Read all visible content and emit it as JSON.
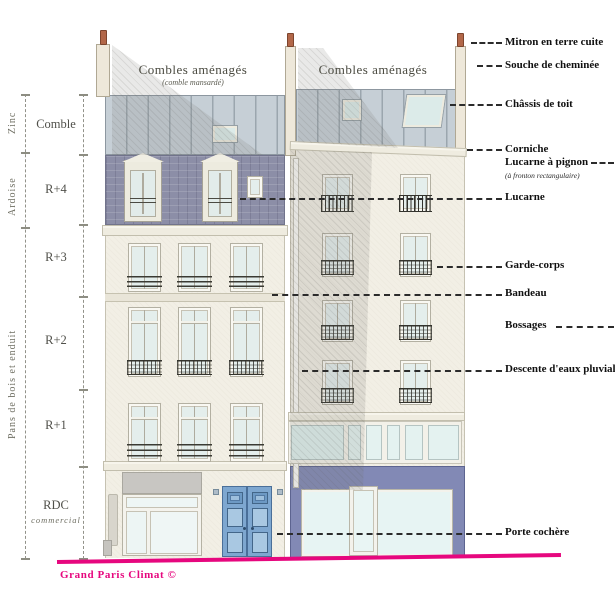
{
  "left_scale": {
    "materials": [
      "Zinc",
      "Ardoise",
      "Pans de bois   et enduit"
    ],
    "floors": [
      "Comble",
      "R+4",
      "R+3",
      "R+2",
      "R+1",
      "RDC"
    ],
    "rdc_sublabel": "commercial"
  },
  "roof": {
    "left_title": "Combles aménagés",
    "left_subtitle": "(comble mansardé)",
    "right_title": "Combles aménagés"
  },
  "annotations": [
    {
      "label": "Mitron en terre cuite"
    },
    {
      "label": "Souche de cheminée"
    },
    {
      "label": "Châssis de toit"
    },
    {
      "label": "Corniche"
    },
    {
      "label": "Lucarne à pignon",
      "sublabel": "(à fronton rectangulaire)"
    },
    {
      "label": "Lucarne"
    },
    {
      "label": "Garde-corps"
    },
    {
      "label": "Bandeau"
    },
    {
      "label": "Bossages"
    },
    {
      "label": "Descente d'eaux pluviales"
    },
    {
      "label": "Porte cochère"
    }
  ],
  "footer": {
    "credit": "Grand Paris Climat ©"
  },
  "colors": {
    "accent_pink": "#e6077e",
    "facade_cream": "#f2efe5",
    "zinc_roof": "#c6cfd6",
    "slate_mansard": "#8c8ea7",
    "shopfront_purple": "#8289b5",
    "door_blue": "#7ea7d0",
    "terracotta_mitron": "#b26749"
  }
}
